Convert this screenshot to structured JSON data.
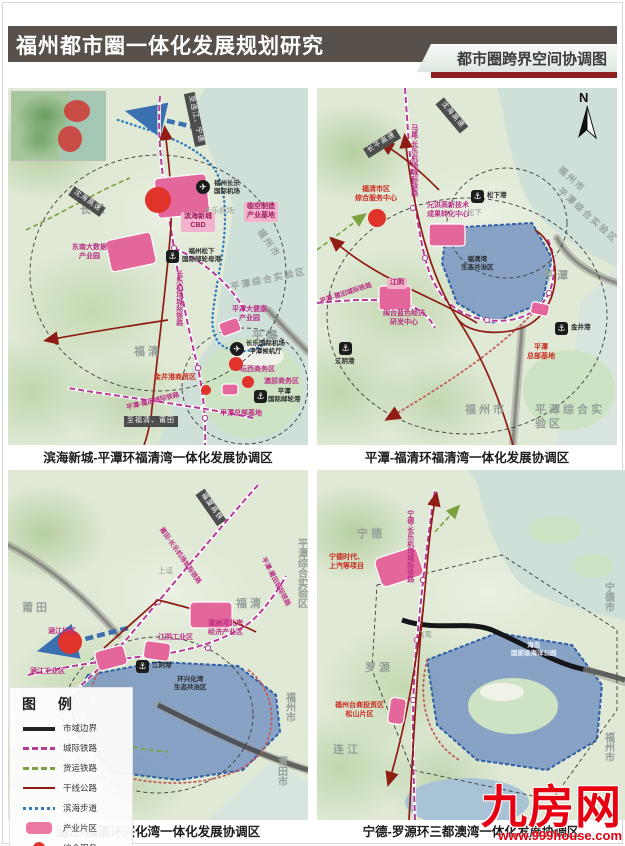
{
  "header": {
    "title": "福州都市圈一体化发展规划研究",
    "tab": "都市圈跨界空间协调图"
  },
  "colors": {
    "header_bar": "#57504b",
    "tab_red_strip": "#8e2020",
    "intercity_rail": "#b43b96",
    "freight_rail": "#7aa23c",
    "trunk_highway": "#8f1d15",
    "coastal_walkway": "#2f7cc0",
    "industry_zone": "#e4679b",
    "service_node": "#e0332a",
    "eco_zone": "#7b97c3",
    "watermark_red": "#e60012"
  },
  "maps": [
    {
      "caption": "滨海新城-平潭环福清湾一体化发展协调区",
      "labels": [
        {
          "t": "至连江、宁德",
          "c": "plate",
          "x": 160,
          "y": 26,
          "r": 78
        },
        {
          "t": "长乐",
          "c": "gray",
          "x": 72,
          "y": 116
        },
        {
          "t": "沈海高速",
          "c": "plate",
          "x": 60,
          "y": 108,
          "r": 35
        },
        {
          "t": "东南大数据\n产业园",
          "c": "pink",
          "x": 64,
          "y": 156
        },
        {
          "t": "临空制造\n产业基地",
          "c": "pinkbox",
          "x": 236,
          "y": 114
        },
        {
          "t": "✈",
          "c": "airicon",
          "x": 188,
          "y": 92
        },
        {
          "t": "福州长乐\n国际机场",
          "c": "dark",
          "x": 206,
          "y": 92
        },
        {
          "t": "长乐机场",
          "c": "graysm",
          "x": 196,
          "y": 118
        },
        {
          "t": "滨海新城\nCBD",
          "c": "pinkbox",
          "x": 173,
          "y": 124
        },
        {
          "t": "⚓",
          "c": "porticon",
          "x": 158,
          "y": 162
        },
        {
          "t": "福州松下\n国际邮轮母港",
          "c": "dark",
          "x": 174,
          "y": 160
        },
        {
          "t": "长乐机场城际铁路",
          "c": "pinkv",
          "v": 1,
          "x": 166,
          "y": 182
        },
        {
          "t": "福州市",
          "c": "grayrot",
          "x": 244,
          "y": 150,
          "r": 55
        },
        {
          "t": "平潭综合实验区",
          "c": "grayrot",
          "x": 222,
          "y": 186,
          "r": -12
        },
        {
          "t": "福清",
          "c": "gray",
          "x": 126,
          "y": 258
        },
        {
          "t": "平潭",
          "c": "gray",
          "x": 244,
          "y": 242
        },
        {
          "t": "平潭大健康\n产业园",
          "c": "pink",
          "x": 224,
          "y": 218
        },
        {
          "t": "✈",
          "c": "airicon",
          "x": 222,
          "y": 254
        },
        {
          "t": "长乐国际机场\n平潭候机厅",
          "c": "dark",
          "x": 238,
          "y": 252
        },
        {
          "t": "坛西商务区",
          "c": "pink",
          "x": 232,
          "y": 278
        },
        {
          "t": "澳前商务区",
          "c": "pink",
          "x": 256,
          "y": 290
        },
        {
          "t": "金井港商贸区",
          "c": "red",
          "x": 146,
          "y": 286
        },
        {
          "t": "平潭总部基地",
          "c": "pink",
          "x": 212,
          "y": 322
        },
        {
          "t": "⚓",
          "c": "porticon",
          "x": 246,
          "y": 302
        },
        {
          "t": "平潭\n国际邮轮港",
          "c": "dark",
          "x": 260,
          "y": 300
        },
        {
          "t": "平潭-莆田城际铁路",
          "c": "pinkrot",
          "x": 118,
          "y": 310,
          "r": -14
        },
        {
          "t": "至福清、莆田",
          "c": "plate",
          "x": 116,
          "y": 328
        }
      ]
    },
    {
      "caption": "平潭-福清环福清湾一体化发展协调区",
      "labels": [
        {
          "t": "N",
          "c": "north",
          "x": 262,
          "y": 2
        },
        {
          "t": "沈海高速",
          "c": "plate",
          "x": 116,
          "y": 22,
          "r": 50
        },
        {
          "t": "长平高速",
          "c": "plate",
          "x": 46,
          "y": 50,
          "r": -32
        },
        {
          "t": "马尾-长乐机场城际铁路",
          "c": "pinkv",
          "v": 1,
          "x": 92,
          "y": 36
        },
        {
          "t": "⚓",
          "c": "porticon",
          "x": 154,
          "y": 102
        },
        {
          "t": "松下港",
          "c": "dark",
          "x": 170,
          "y": 104
        },
        {
          "t": "松下",
          "c": "graysm",
          "x": 150,
          "y": 120
        },
        {
          "t": "福州市",
          "c": "grayrot",
          "x": 238,
          "y": 86,
          "r": 42
        },
        {
          "t": "平潭综合实验区",
          "c": "grayrot",
          "x": 232,
          "y": 122,
          "r": 42
        },
        {
          "t": "福清市区\n综合服务中心",
          "c": "red",
          "x": 38,
          "y": 98
        },
        {
          "t": "元洪高新技术\n成果转化中心",
          "c": "pink",
          "x": 110,
          "y": 114
        },
        {
          "t": "福清湾\n生态共治区",
          "c": "dark",
          "x": 144,
          "y": 168
        },
        {
          "t": "平潭",
          "c": "gray",
          "x": 226,
          "y": 182
        },
        {
          "t": "江阴",
          "c": "pinkbox",
          "x": 70,
          "y": 190
        },
        {
          "t": "闽台蓝色经济\n研发中心",
          "c": "pink",
          "x": 66,
          "y": 222
        },
        {
          "t": "平潭-莆田城际铁路",
          "c": "pinkrot",
          "x": 2,
          "y": 202,
          "r": -18
        },
        {
          "t": "⚓",
          "c": "porticon",
          "x": 22,
          "y": 254
        },
        {
          "t": "江阴港",
          "c": "dark",
          "x": 18,
          "y": 270
        },
        {
          "t": "⚓",
          "c": "porticon",
          "x": 238,
          "y": 234
        },
        {
          "t": "金井港",
          "c": "dark",
          "x": 254,
          "y": 236
        },
        {
          "t": "平潭\n总部基地",
          "c": "red",
          "x": 210,
          "y": 256
        },
        {
          "t": "福州市",
          "c": "gray",
          "x": 148,
          "y": 316
        },
        {
          "t": "平潭综合实验区",
          "c": "gray",
          "x": 218,
          "y": 316
        }
      ]
    },
    {
      "caption": "涵江-福清环兴化湾一体化发展协调区",
      "labels": [
        {
          "t": "福厦高铁",
          "c": "plate",
          "x": 184,
          "y": 32,
          "r": 55
        },
        {
          "t": "莆田-长乐机场城际铁路",
          "c": "pinkrot",
          "x": 138,
          "y": 82,
          "r": 55
        },
        {
          "t": "上迳",
          "c": "graysm",
          "x": 150,
          "y": 96
        },
        {
          "t": "莆田",
          "c": "gray",
          "x": 14,
          "y": 132
        },
        {
          "t": "福清",
          "c": "gray",
          "x": 228,
          "y": 128
        },
        {
          "t": "平潭综合实验区",
          "c": "grayv",
          "v": 1,
          "x": 286,
          "y": 68
        },
        {
          "t": "平潭-莆田城际铁路",
          "c": "pinkrot",
          "x": 240,
          "y": 108,
          "r": 62
        },
        {
          "t": "涵江片区",
          "c": "pink",
          "x": 40,
          "y": 158
        },
        {
          "t": "湄洲湾北岸\n经济产业区",
          "c": "pink",
          "x": 200,
          "y": 150
        },
        {
          "t": "江阴工业区",
          "c": "pink",
          "x": 150,
          "y": 164
        },
        {
          "t": "涵江工业区",
          "c": "pink",
          "x": 22,
          "y": 198
        },
        {
          "t": "⚓",
          "c": "porticon",
          "x": 128,
          "y": 190
        },
        {
          "t": "江阴港",
          "c": "dark",
          "x": 144,
          "y": 192
        },
        {
          "t": "环兴化湾\n生态共治区",
          "c": "dark",
          "x": 166,
          "y": 206
        },
        {
          "t": "福州市",
          "c": "grayv",
          "v": 1,
          "x": 274,
          "y": 222
        },
        {
          "t": "莆田市",
          "c": "grayv",
          "v": 1,
          "x": 266,
          "y": 286
        }
      ]
    },
    {
      "caption": "宁德-罗源环三都澳湾一体化发展协调区",
      "labels": [
        {
          "t": "宁德",
          "c": "gray",
          "x": 40,
          "y": 58
        },
        {
          "t": "宁德-长乐机场城际铁路",
          "c": "pinkv",
          "v": 1,
          "x": 88,
          "y": 40
        },
        {
          "t": "宁德时代、\n上汽等项目",
          "c": "red",
          "x": 12,
          "y": 84
        },
        {
          "t": "海岛\n国家级海洋公园",
          "c": "white",
          "x": 194,
          "y": 172
        },
        {
          "t": "飞鸾",
          "c": "graysm",
          "x": 100,
          "y": 160
        },
        {
          "t": "罗源",
          "c": "gray",
          "x": 48,
          "y": 192
        },
        {
          "t": "福州台商投资区\n松山片区",
          "c": "red",
          "x": 18,
          "y": 232
        },
        {
          "t": "连江",
          "c": "gray",
          "x": 16,
          "y": 274
        },
        {
          "t": "宁德市",
          "c": "grayv",
          "v": 1,
          "x": 284,
          "y": 112
        },
        {
          "t": "福州市",
          "c": "grayv",
          "v": 1,
          "x": 284,
          "y": 262
        }
      ]
    }
  ],
  "legend": {
    "title": "图  例",
    "items": [
      {
        "label": "市域边界",
        "sym": "line-black"
      },
      {
        "label": "城际铁路",
        "sym": "dash-magenta"
      },
      {
        "label": "货运铁路",
        "sym": "dash-green"
      },
      {
        "label": "干线公路",
        "sym": "line-red"
      },
      {
        "label": "滨海步道",
        "sym": "dot-blue"
      },
      {
        "label": "产业片区",
        "sym": "rect-pink"
      },
      {
        "label": "综合服务",
        "sym": "circle-red"
      },
      {
        "label": "生态共治区",
        "sym": "rect-blue"
      }
    ]
  },
  "watermark": {
    "brand": "九房网",
    "url": "www.999house.com"
  }
}
